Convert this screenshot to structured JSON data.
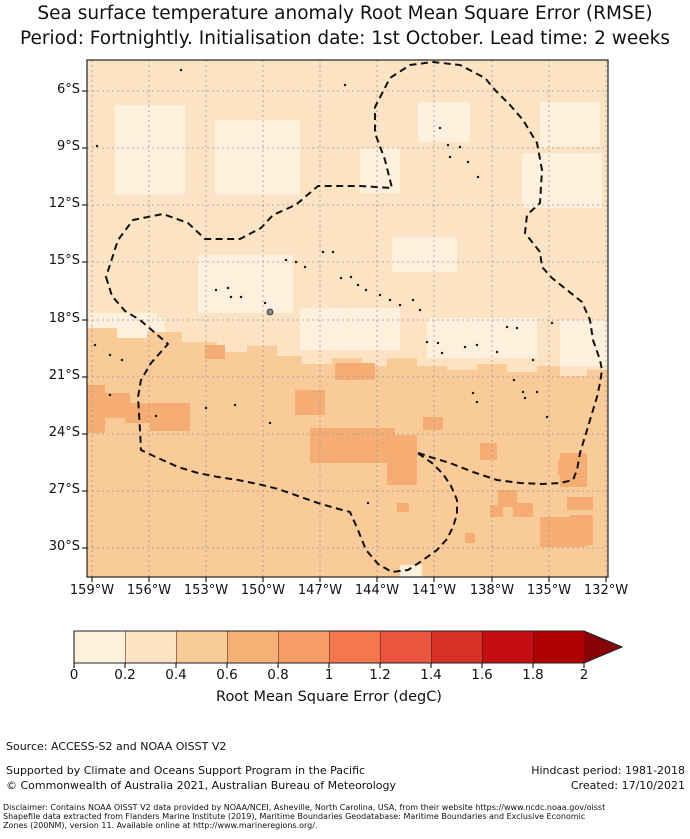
{
  "title": {
    "line1": "Sea surface temperature anomaly Root Mean Square Error (RMSE)",
    "line2": "Period: Fortnightly. Initialisation date: 1st October. Lead time: 2 weeks"
  },
  "map": {
    "lat_ticks": [
      "6°S",
      "9°S",
      "12°S",
      "15°S",
      "18°S",
      "21°S",
      "24°S",
      "27°S",
      "30°S"
    ],
    "lon_ticks": [
      "159°W",
      "156°W",
      "153°W",
      "150°W",
      "147°W",
      "144°W",
      "141°W",
      "138°W",
      "135°W",
      "132°W"
    ],
    "colors": {
      "base_north": "#fbe3c3",
      "light_patch": "#fdf0dd",
      "base_south": "#f8cb99",
      "dark_patch": "#f5ad74",
      "grid": "#9a9a9a",
      "boundary": "#111111",
      "island": "#1a1a1a",
      "tahiti_fill": "#8a8a8a",
      "spine": "#222222"
    },
    "geometry": {
      "grid_vx": [
        5,
        62,
        119,
        176,
        233,
        290,
        347,
        405,
        462,
        519
      ],
      "grid_hy": [
        31,
        88,
        145,
        202,
        260,
        317,
        374,
        431,
        488
      ],
      "transition_poly": "0,268 30,268 30,278 60,278 60,272 95,272 95,282 130,282 130,292 160,292 160,286 190,286 190,296 215,296 215,304 245,304 245,298 275,298 275,306 300,306 300,298 330,298 330,306 360,306 360,310 390,310 390,304 420,304 420,312 450,312 450,306 473,306 473,316 500,316 500,310 521,310 521,517 0,517",
      "light_patches": [
        [
          28,
          45,
          70,
          90
        ],
        [
          128,
          60,
          85,
          75
        ],
        [
          111,
          195,
          95,
          58
        ],
        [
          273,
          88,
          40,
          45
        ],
        [
          331,
          42,
          52,
          40
        ],
        [
          453,
          42,
          60,
          45
        ],
        [
          435,
          93,
          80,
          55
        ],
        [
          305,
          177,
          65,
          35
        ],
        [
          2,
          253,
          68,
          30
        ],
        [
          39,
          258,
          39,
          20
        ],
        [
          213,
          248,
          100,
          42
        ],
        [
          340,
          258,
          110,
          40
        ],
        [
          473,
          260,
          48,
          46
        ]
      ],
      "light_patches_south": [
        [
          313,
          505,
          22,
          12
        ]
      ],
      "dark_patches": [
        [
          0,
          325,
          18,
          48
        ],
        [
          13,
          333,
          30,
          25
        ],
        [
          38,
          343,
          40,
          20
        ],
        [
          63,
          343,
          40,
          28
        ],
        [
          118,
          285,
          20,
          14
        ],
        [
          208,
          330,
          30,
          25
        ],
        [
          223,
          368,
          85,
          35
        ],
        [
          243,
          370,
          60,
          30
        ],
        [
          300,
          375,
          30,
          50
        ],
        [
          248,
          303,
          40,
          17
        ],
        [
          336,
          357,
          20,
          13
        ],
        [
          471,
          400,
          22,
          15
        ],
        [
          480,
          437,
          26,
          13
        ],
        [
          453,
          457,
          47,
          30
        ],
        [
          403,
          445,
          13,
          12
        ],
        [
          411,
          430,
          19,
          17
        ],
        [
          393,
          383,
          17,
          17
        ],
        [
          473,
          393,
          27,
          34
        ],
        [
          483,
          455,
          23,
          30
        ],
        [
          426,
          443,
          20,
          14
        ],
        [
          378,
          473,
          10,
          10
        ],
        [
          310,
          443,
          12,
          9
        ]
      ],
      "eez_path": "M19,217 L25,236 L38,251 L53,260 L81,284 L64,303 L54,320 L51,337 L53,370 L54,390 L71,398 L91,407 L111,413 L131,417 L151,420 L171,424 L191,429 L211,436 L231,443 L248,448 L263,452 L271,470 L279,490 L291,504 L305,512 L321,510 L336,500 L350,490 L360,479 L366,467 L370,454 L370,440 L364,426 L356,414 L345,403 L329,392 L343,397 L363,403 L386,412 L410,420 L433,423 L456,424 L473,423 L486,420 L490,410 L493,393 L500,370 L506,350 L510,337 L513,323 L515,310 L513,300 L506,280 L503,260 L495,242 L480,230 L465,218 L455,207 L453,192 L438,173 L440,155 L453,143 L455,110 L450,83 L436,60 L423,45 L408,30 L398,18 L373,5 L346,2 L323,5 L303,18 L288,47 L288,73 L298,100 L305,128 L273,126 L231,126 L211,143 L204,147 L186,155 L174,168 L153,179 L118,179 L101,163 L76,154 L46,160 L31,180 Z",
      "islands": [
        [
          258,
          25
        ],
        [
          94,
          10
        ],
        [
          10,
          86
        ],
        [
          353,
          68
        ],
        [
          361,
          85
        ],
        [
          373,
          87
        ],
        [
          363,
          97
        ],
        [
          381,
          102
        ],
        [
          391,
          117
        ],
        [
          199,
          200
        ],
        [
          209,
          202
        ],
        [
          218,
          207
        ],
        [
          236,
          192
        ],
        [
          246,
          192
        ],
        [
          254,
          218
        ],
        [
          264,
          217
        ],
        [
          271,
          225
        ],
        [
          279,
          230
        ],
        [
          293,
          235
        ],
        [
          303,
          240
        ],
        [
          313,
          245
        ],
        [
          326,
          240
        ],
        [
          333,
          250
        ],
        [
          340,
          282
        ],
        [
          351,
          283
        ],
        [
          355,
          293
        ],
        [
          378,
          287
        ],
        [
          390,
          285
        ],
        [
          420,
          267
        ],
        [
          430,
          268
        ],
        [
          427,
          320
        ],
        [
          436,
          332
        ],
        [
          450,
          332
        ],
        [
          438,
          338
        ],
        [
          386,
          333
        ],
        [
          390,
          342
        ],
        [
          460,
          357
        ],
        [
          446,
          300
        ],
        [
          410,
          292
        ],
        [
          129,
          230
        ],
        [
          141,
          228
        ],
        [
          144,
          237
        ],
        [
          154,
          237
        ],
        [
          178,
          243
        ],
        [
          69,
          356
        ],
        [
          119,
          348
        ],
        [
          148,
          345
        ],
        [
          183,
          363
        ],
        [
          281,
          443
        ],
        [
          23,
          335
        ],
        [
          465,
          263
        ],
        [
          8,
          285
        ],
        [
          23,
          295
        ],
        [
          35,
          300
        ]
      ],
      "tahiti": [
        183,
        252
      ]
    }
  },
  "colorbar": {
    "ticks": [
      "0",
      "0.2",
      "0.4",
      "0.6",
      "0.8",
      "1",
      "1.2",
      "1.4",
      "1.6",
      "1.8",
      "2"
    ],
    "segment_colors": [
      "#fdf0dd",
      "#fbe3c3",
      "#f8cb99",
      "#f5b076",
      "#f59d64",
      "#f4774e",
      "#ea553d",
      "#d63127",
      "#c60d12",
      "#ae0205"
    ],
    "arrow_color": "#860308",
    "label": "Root Mean Square Error (degC)"
  },
  "footer": {
    "source": "Source: ACCESS-S2 and NOAA OISST V2",
    "supported": "Supported by Climate and Oceans Support Program in the Pacific",
    "copyright": "© Commonwealth of Australia 2021, Australian Bureau of Meteorology",
    "hindcast": "Hindcast period: 1981-2018",
    "created": "Created: 17/10/2021"
  },
  "disclaimer": {
    "line1": "Disclaimer: Contains NOAA OISST V2 data provided by NOAA/NCEI, Asheville, North Carolina, USA, from their website https://www.ncdc.noaa.gov/oisst",
    "line2": "Shapefile data extracted from Flanders Marine Institute (2019), Maritime Boundaries Geodatabase: Maritime Boundaries and Exclusive Economic",
    "line3": "Zones (200NM), version 11. Available online at http://www.marineregions.org/."
  },
  "chart_data": {
    "type": "heatmap",
    "title": "Sea surface temperature anomaly Root Mean Square Error (RMSE)",
    "subtitle": "Period: Fortnightly. Initialisation date: 1st October. Lead time: 2 weeks",
    "xlabel": "Longitude",
    "ylabel": "Latitude",
    "x_ticks": [
      "159°W",
      "156°W",
      "153°W",
      "150°W",
      "147°W",
      "144°W",
      "141°W",
      "138°W",
      "135°W",
      "132°W"
    ],
    "y_ticks": [
      "6°S",
      "9°S",
      "12°S",
      "15°S",
      "18°S",
      "21°S",
      "24°S",
      "27°S",
      "30°S"
    ],
    "x_range_deg_west": [
      159.2,
      131.9
    ],
    "y_range_deg_south": [
      4.5,
      31.5
    ],
    "grid": true,
    "colorbar": {
      "label": "Root Mean Square Error (degC)",
      "ticks": [
        0,
        0.2,
        0.4,
        0.6,
        0.8,
        1,
        1.2,
        1.4,
        1.6,
        1.8,
        2
      ],
      "bin_edges": [
        0,
        0.2,
        0.4,
        0.6,
        0.8,
        1,
        1.2,
        1.4,
        1.6,
        1.8,
        2
      ],
      "extend": "max",
      "colormap": "OrRd-like discrete"
    },
    "regions": [
      {
        "area": "north of ~19°S (most of map)",
        "rmse_range": [
          0.2,
          0.4
        ]
      },
      {
        "area": "scattered patches 6°S–13°S and around Tuamotu/Society Islands",
        "rmse_range": [
          0,
          0.2
        ]
      },
      {
        "area": "south of ~19°S",
        "rmse_range": [
          0.4,
          0.6
        ]
      },
      {
        "area": "scattered patches south of 21°S",
        "rmse_range": [
          0.6,
          0.8
        ]
      }
    ],
    "overlays": [
      "Dashed boundary: French Polynesia Exclusive Economic Zone (200NM), incl. Marquesas lobe and circular high-seas pocket in the south",
      "Black specks: islands (Marquesas, Tuamotu, Society, Austral groups)"
    ]
  }
}
